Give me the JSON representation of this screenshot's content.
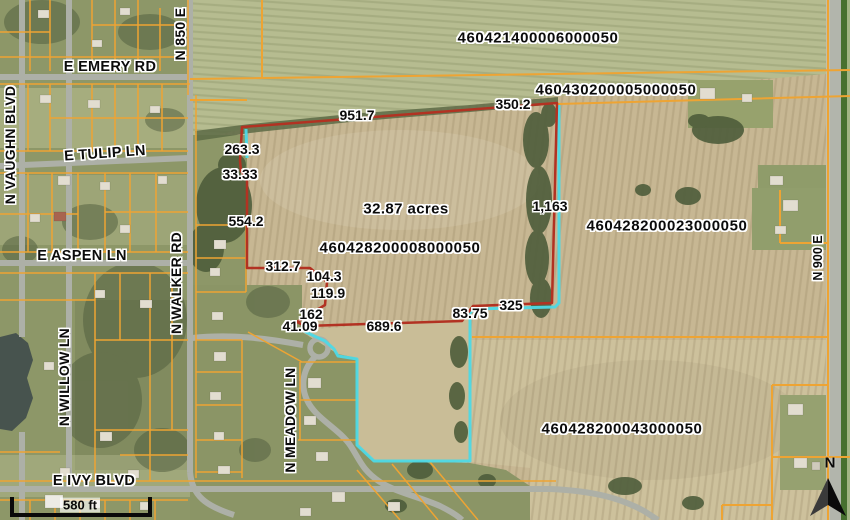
{
  "map_labels": {
    "parcel_ids": {
      "north": "460421400006000050",
      "northeast": "460430200005000050",
      "subject": "460428200008000050",
      "east": "460428200023000050",
      "south": "460428200043000050"
    },
    "subject_area": "32.87 acres",
    "dimensions": {
      "d951": "951.7",
      "d350": "350.2",
      "d263": "263.3",
      "d33": "33.33",
      "d554": "554.2",
      "d1163": "1,163",
      "d312": "312.7",
      "d104": "104.3",
      "d119": "119.9",
      "d162": "162",
      "d41": "41.09",
      "d689": "689.6",
      "d83": "83.75",
      "d325": "325"
    },
    "streets": {
      "emery": "E EMERY RD",
      "tulip": "E TULIP LN",
      "aspen": "E ASPEN LN",
      "ivy": "E IVY BLVD",
      "vaughn": "N VAUGHN BLVD",
      "willow": "N WILLOW LN",
      "walker": "N WALKER RD",
      "n850": "N 850 E",
      "meadow": "N MEADOW LN",
      "n900": "N 900 E"
    },
    "scale_bar": "580 ft",
    "north_arrow": "N",
    "colors": {
      "parcel_line": "#EEA433",
      "subject_boundary": "#B23222",
      "highlight_boundary": "#4DD9E6"
    }
  }
}
